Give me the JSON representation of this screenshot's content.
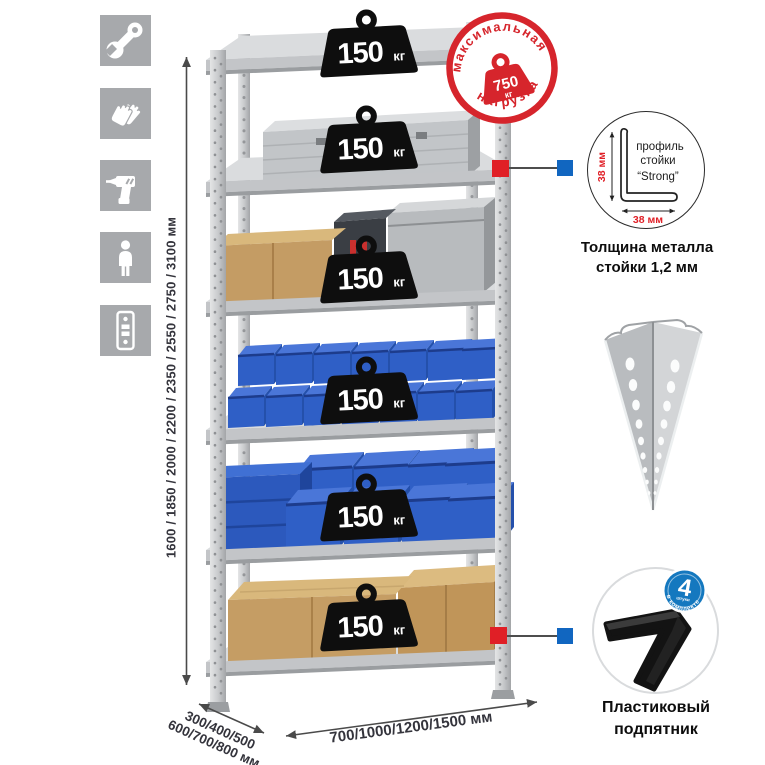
{
  "colors": {
    "accent_red": "#d6252c",
    "callout_red": "#e01f26",
    "callout_blue": "#1166c0",
    "badge_blue": "#1478bf",
    "tile_gray": "#a7a9ac"
  },
  "left_icons": {
    "items": [
      {
        "name": "wrench-icon"
      },
      {
        "name": "gloves-icon"
      },
      {
        "name": "drill-icon"
      },
      {
        "name": "person-icon"
      },
      {
        "name": "rack-post-icon"
      }
    ]
  },
  "dimensions": {
    "height": "1600 / 1850 / 2000 / 2200 / 2350 / 2550 / 2750 / 3100 мм",
    "depth_line1": "300/400/500",
    "depth_line2": "600/700/800 мм",
    "width": "700/1000/1200/1500 мм"
  },
  "rack": {
    "shelves": 6,
    "per_shelf_load": {
      "value": "150",
      "unit": "кг"
    }
  },
  "stamp": {
    "top": "максимальная",
    "bottom": "нагрузка",
    "value": "750",
    "unit": "кг"
  },
  "profile": {
    "dim_v": "38 мм",
    "dim_h": "38 мм",
    "label": [
      "профиль",
      "стойки",
      "“Strong”"
    ],
    "caption": [
      "Толщина металла",
      "стойки 1,2 мм"
    ]
  },
  "foot": {
    "badge_value": "4",
    "badge_sub": "штуки",
    "badge_arc": "в комплекте",
    "caption": [
      "Пластиковый",
      "подпятник"
    ]
  }
}
